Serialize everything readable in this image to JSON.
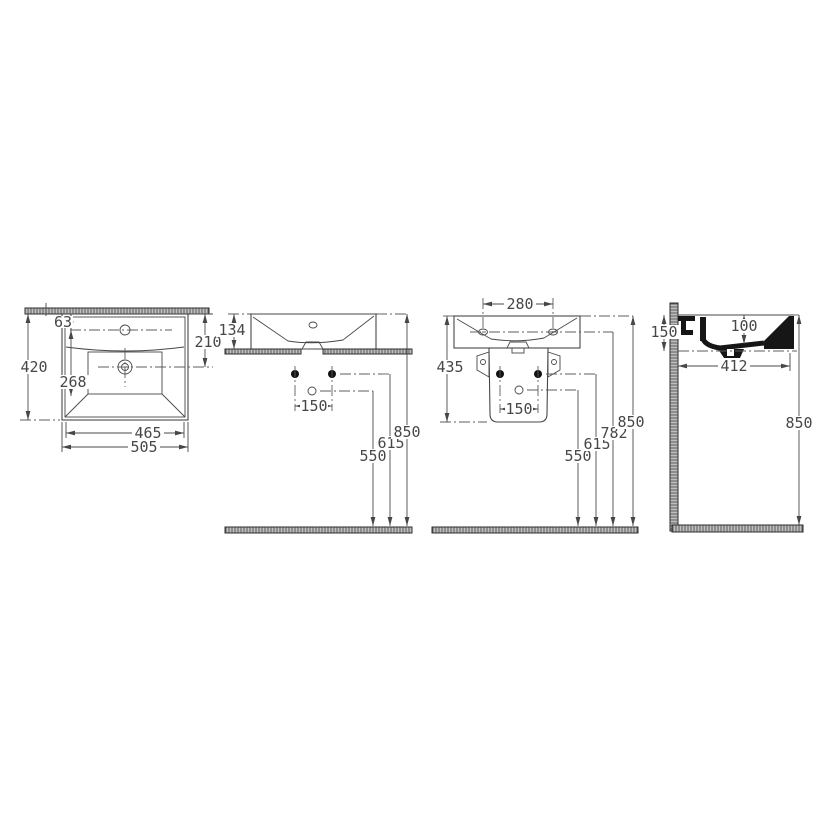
{
  "drawing": {
    "type": "washbasin technical dimension drawing",
    "colors": {
      "line": "#474747",
      "section_fill": "#161616",
      "hatch": "#bdbdbd"
    },
    "views": {
      "top": {
        "dims": {
          "total_depth": "420",
          "rim_to_tap": "63",
          "tap_to_drain": "268",
          "rim_to_drain": "210",
          "bowl_width": "465",
          "total_width": "505"
        }
      },
      "front": {
        "dims": {
          "front_height": "134",
          "bolt_spacing": "150",
          "drain_height": "550",
          "bolt_height": "615",
          "rim_height": "850"
        }
      },
      "front_pedestal": {
        "dims": {
          "tap_spacing": "280",
          "basin_pedestal_height": "435",
          "bolt_spacing": "150",
          "drain_height": "550",
          "bolt_height": "615",
          "tap_height": "782",
          "rim_height": "850"
        }
      },
      "side": {
        "dims": {
          "rim_depth": "150",
          "bowl_depth": "100",
          "projection": "412",
          "rim_height": "850"
        }
      }
    }
  }
}
